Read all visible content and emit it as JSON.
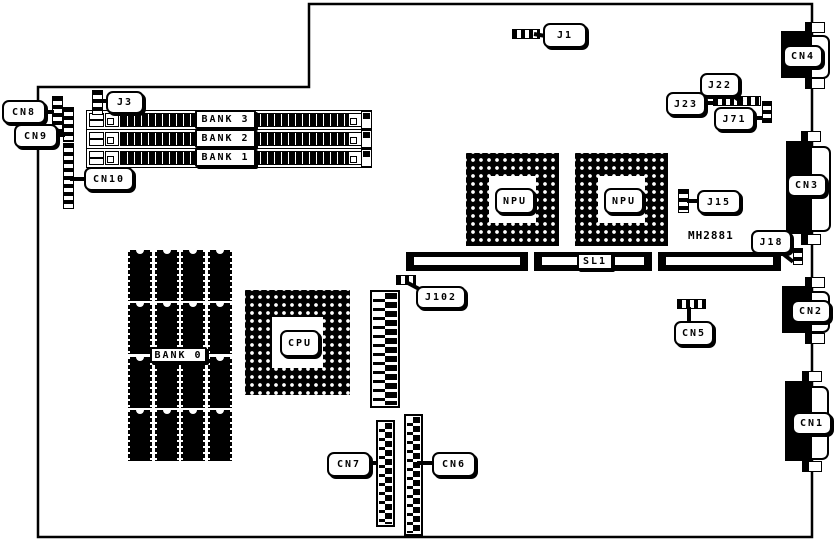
{
  "diagram": {
    "type": "motherboard-layout-diagram",
    "ink_color": "#000000",
    "background_color": "#ffffff"
  },
  "labels": {
    "j1": "J1",
    "j3": "J3",
    "j15": "J15",
    "j18": "J18",
    "j22": "J22",
    "j23": "J23",
    "j71": "J71",
    "j102": "J102",
    "cn1": "CN1",
    "cn2": "CN2",
    "cn3": "CN3",
    "cn4": "CN4",
    "cn5": "CN5",
    "cn6": "CN6",
    "cn7": "CN7",
    "cn8": "CN8",
    "cn9": "CN9",
    "cn10": "CN10",
    "bank0": "BANK 0",
    "bank1": "BANK 1",
    "bank2": "BANK 2",
    "bank3": "BANK 3",
    "cpu": "CPU",
    "npu": "NPU",
    "sl1": "SL1",
    "part_number": "MH2881"
  }
}
